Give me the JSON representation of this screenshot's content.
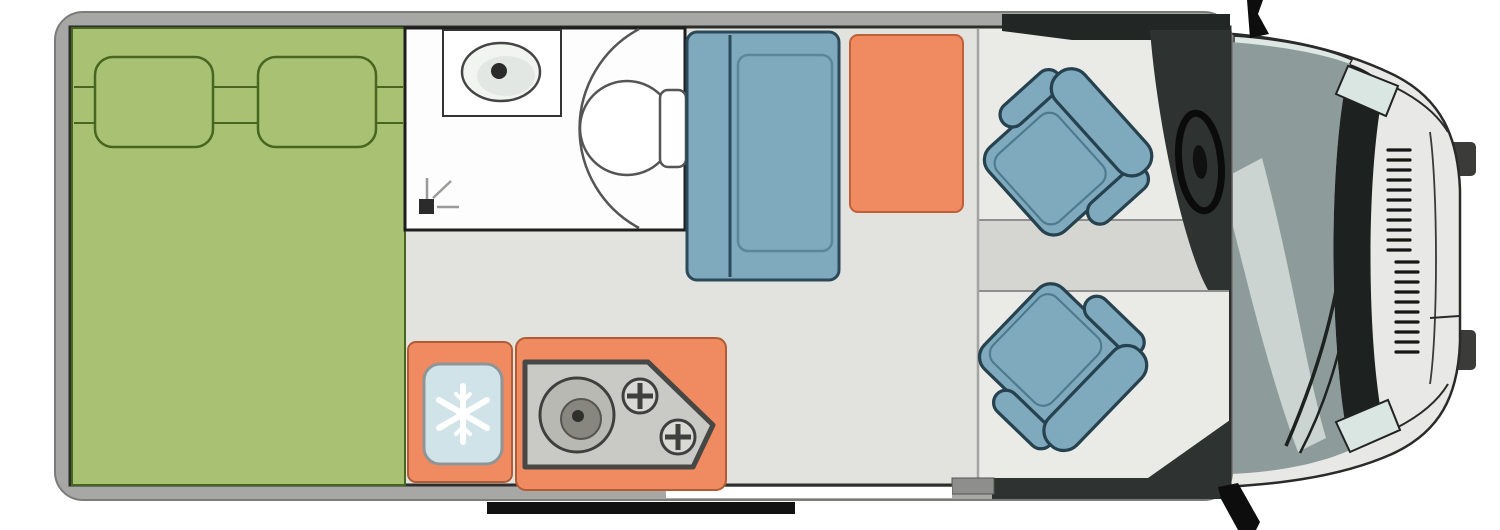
{
  "diagram": {
    "kind": "campervan-floorplan",
    "view": "top-down layout of a van conversion motorhome",
    "areas": {
      "bed": {
        "name": "double-bed",
        "pillows": 2
      },
      "bathroom": {
        "name": "washroom",
        "fixtures": [
          "sink",
          "shower-drain",
          "swivel-toilet"
        ]
      },
      "kitchen": {
        "name": "kitchenette",
        "fixtures": [
          "refrigerator",
          "round-sink",
          "burner",
          "burner"
        ]
      },
      "lounge": {
        "name": "lounge",
        "furniture": [
          "sofa-bench",
          "table"
        ]
      },
      "cab": {
        "name": "driver-cab",
        "furniture": [
          "swivel-seat-front",
          "swivel-seat-rear",
          "steering-wheel",
          "dashboard"
        ]
      },
      "exterior": {
        "features": [
          "sliding-door-opening",
          "entry-step",
          "wing-mirror-top",
          "wing-mirror-bottom",
          "windshield",
          "hood",
          "grille",
          "headlight-top",
          "headlight-bottom"
        ]
      }
    },
    "counts": {
      "seats": 2,
      "burners": 2,
      "pillows": 2
    }
  },
  "colors": {
    "wall": "#a7a7a5",
    "wallEdge": "#7b7b79",
    "innerLine": "#2d2d2b",
    "floor": "#e2e2de",
    "cabFloor": "#eaeae7",
    "cabBand": "#d5d5d1",
    "bed": "#a9c173",
    "bedLine": "#47661f",
    "bath": "#fdfdfd",
    "orange": "#ef8a61",
    "orangeEdge": "#c06038",
    "blue": "#7fa9bd",
    "blueEdge": "#2b4a59",
    "unitGray": "#c9c9c5",
    "unitEdge": "#474745",
    "fridgeBlue": "#cfe3e9",
    "glass": "#8d9c9a",
    "glassLight": "#ccd4d1",
    "cowl": "#1d211f",
    "body": "#e8e8e6",
    "headlight": "#d9e6e1",
    "dashboard": "#2e3230",
    "dark": "#0d0d0d",
    "step": "#111111",
    "white": "#ffffff"
  }
}
